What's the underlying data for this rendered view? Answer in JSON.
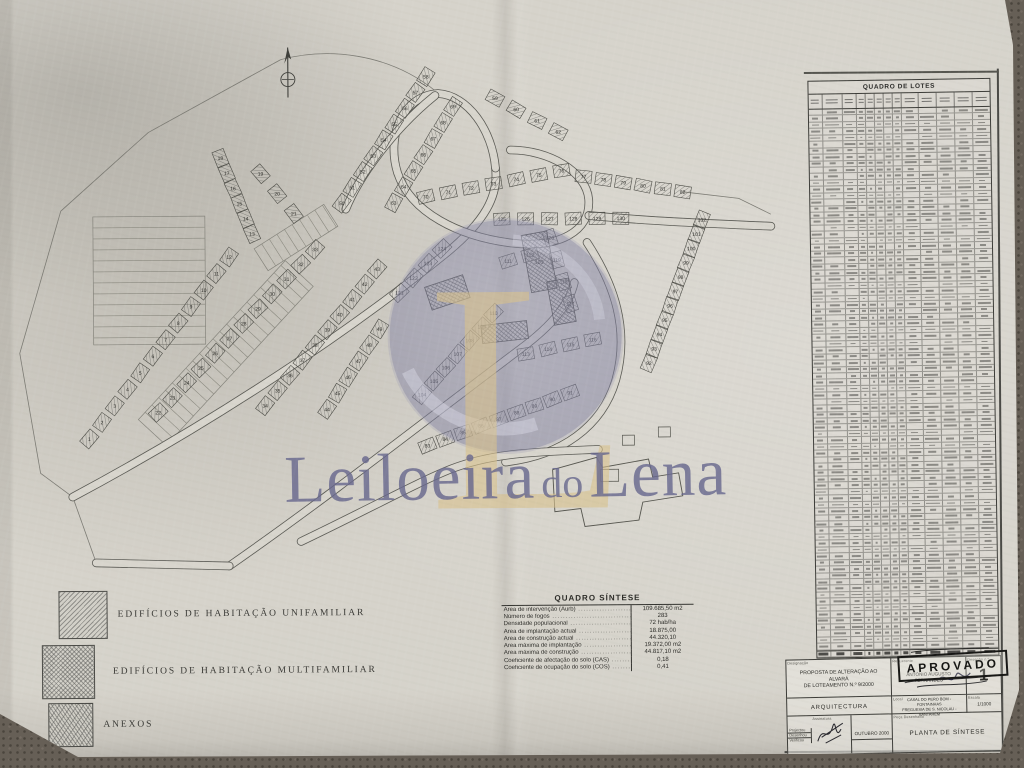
{
  "watermark": {
    "brand_left": "Leiloeira",
    "brand_mid": "do",
    "brand_right": "Lena",
    "monogram": "L"
  },
  "north_arrow": "north-arrow",
  "legend": {
    "items": [
      {
        "label": "EDIFÍCIOS  DE  HABITAÇÃO  UNIFAMILIAR",
        "pattern": "diagonal-hatch"
      },
      {
        "label": "EDIFÍCIOS  DE  HABITAÇÃO  MULTIFAMILIAR",
        "pattern": "cross-hatch"
      },
      {
        "label": "ANEXOS",
        "pattern": "zigzag-hatch"
      }
    ]
  },
  "quadro_sintese": {
    "title": "QUADRO SÍNTESE",
    "rows": [
      [
        "Área de intervenção (Aurb)",
        "109.685,50  m2"
      ],
      [
        "Número de fogos",
        "283"
      ],
      [
        "Densidade populacional",
        "72  hab/ha"
      ],
      [
        "Área de implantação actual",
        "18.875,00"
      ],
      [
        "Área de construção actual",
        "44.320,10"
      ],
      [
        "Área máxima de implantação",
        "19.372,00  m2"
      ],
      [
        "Área máxima de construção",
        "44.817,10  m2"
      ],
      [
        "Coeficiente de afectação do solo (CAS)",
        "0,18"
      ],
      [
        "Coeficiente de ocupação do solo (COS)",
        "0,41"
      ]
    ]
  },
  "quadro_lotes": {
    "title": "QUADRO DE LOTES",
    "row_count": 84,
    "column_count": 13
  },
  "title_block": {
    "designacao_label": "Designação",
    "designacao_line1": "PROPOSTA DE ALTERAÇÃO AO ALVARÁ",
    "designacao_line2": "DE LOTEAMENTO N.º 9/2000",
    "requerente_label": "Requerente",
    "requerente": "ANTÓNIO AUGUSTO FERNANDES",
    "desenho_label": "Desenho n.º",
    "desenho_num": "1",
    "especialidade": "ARQUITECTURA",
    "local_label": "Local",
    "local_line1": "CASAL DO PERO BOM - FONTAINHAS",
    "local_line2": "FREGUESIA DE S. NICOLAU - SANTARÉM",
    "escala_label": "Escala",
    "escala": "1/1000",
    "sig_rows": [
      "Projectou",
      "Desenhou",
      "Verificou"
    ],
    "assinatura_label": "Assinatura",
    "data_label": "Data",
    "data_value": "OUTUBRO 2000",
    "peca_label": "Peça Desenhada",
    "peca": "PLANTA DE SÍNTESE"
  },
  "stamp": {
    "label": "APROVADO"
  },
  "plan": {
    "lot_clusters": [
      {
        "from": 1,
        "to": 12,
        "x1": 89,
        "y1": 436,
        "x2": 230,
        "y2": 255
      },
      {
        "from": 13,
        "to": 18,
        "x1": 253,
        "y1": 232,
        "x2": 222,
        "y2": 156
      },
      {
        "from": 19,
        "to": 21,
        "x1": 262,
        "y1": 172,
        "x2": 295,
        "y2": 212
      },
      {
        "from": 22,
        "to": 33,
        "x1": 158,
        "y1": 410,
        "x2": 316,
        "y2": 248
      },
      {
        "from": 34,
        "to": 43,
        "x1": 265,
        "y1": 404,
        "x2": 378,
        "y2": 268
      },
      {
        "from": 44,
        "to": 49,
        "x1": 327,
        "y1": 408,
        "x2": 380,
        "y2": 328
      },
      {
        "from": 50,
        "to": 58,
        "x1": 343,
        "y1": 202,
        "x2": 428,
        "y2": 76
      },
      {
        "from": 59,
        "to": 62,
        "x1": 497,
        "y1": 98,
        "x2": 560,
        "y2": 132
      },
      {
        "from": 63,
        "to": 69,
        "x1": 395,
        "y1": 202,
        "x2": 455,
        "y2": 106
      },
      {
        "from": 70,
        "to": 76,
        "x1": 427,
        "y1": 196,
        "x2": 563,
        "y2": 171
      },
      {
        "from": 77,
        "to": 82,
        "x1": 585,
        "y1": 177,
        "x2": 684,
        "y2": 193
      },
      {
        "from": 83,
        "to": 91,
        "x1": 427,
        "y1": 445,
        "x2": 570,
        "y2": 393
      },
      {
        "from": 92,
        "to": 102,
        "x1": 649,
        "y1": 364,
        "x2": 703,
        "y2": 221
      },
      {
        "from": 104,
        "to": 110,
        "x1": 422,
        "y1": 394,
        "x2": 494,
        "y2": 313
      },
      {
        "from": 111,
        "to": 112,
        "x1": 509,
        "y1": 261,
        "x2": 531,
        "y2": 255
      },
      {
        "from": 113,
        "to": 116,
        "x1": 526,
        "y1": 354,
        "x2": 593,
        "y2": 340
      },
      {
        "from": 117,
        "to": 120,
        "x1": 571,
        "y1": 304,
        "x2": 551,
        "y2": 238
      },
      {
        "from": 121,
        "to": 124,
        "x1": 400,
        "y1": 292,
        "x2": 443,
        "y2": 248
      },
      {
        "from": 125,
        "to": 130,
        "x1": 503,
        "y1": 219,
        "x2": 622,
        "y2": 219
      }
    ],
    "multi_blocks": [
      {
        "n": "103",
        "x": 540,
        "y": 262,
        "w": 26,
        "h": 58,
        "r": -10
      },
      {
        "n": "",
        "x": 562,
        "y": 302,
        "w": 22,
        "h": 44,
        "r": -10
      },
      {
        "n": "",
        "x": 448,
        "y": 292,
        "w": 40,
        "h": 24,
        "r": -18
      },
      {
        "n": "",
        "x": 505,
        "y": 332,
        "w": 46,
        "h": 18,
        "r": -6
      }
    ],
    "roads": [
      "M 72,494 C 190,432 330,346 448,252 C 486,221 500,196 497,168",
      "M 228,564 C 330,494 425,420 522,348 C 552,326 570,305 575,283",
      "M 497,168 C 494,130 470,95 440,93 C 404,95 388,136 399,172 C 412,212 460,236 512,243 C 560,249 592,232 590,200 C 588,172 550,150 512,150",
      "M 590,216 C 650,222 710,225 772,228",
      "M 588,243 C 615,285 630,330 616,380 C 602,428 560,456 505,462",
      "M 300,540 C 360,512 420,480 452,468 C 495,452 540,452 598,450",
      "M 347,208 C 362,172 398,126 437,95",
      "M 95,560 L 228,564"
    ],
    "boundary": [
      "M 283,58 L 150,130 L 62,208 L 20,350 L 40,470 L 72,494",
      "M 283,58 C 330,46 390,52 437,90",
      "M 72,494 L 95,560 L 228,564",
      "M 684,193 L 740,200 L 772,216"
    ],
    "strips": [
      {
        "x1": 152,
        "y1": 430,
        "x2": 300,
        "y2": 272,
        "w": 38,
        "step": 10
      },
      {
        "x1": 150,
        "y1": 214,
        "x2": 150,
        "y2": 342,
        "w": 112,
        "step": 11
      },
      {
        "x1": 262,
        "y1": 258,
        "x2": 332,
        "y2": 214,
        "w": 26,
        "step": 9
      }
    ],
    "school_outline": "M 552,470 L 596,458 L 602,468 L 648,460 L 652,478 L 678,474 L 682,497 L 642,503 L 638,521 L 584,527 L 580,509 L 554,512 Z",
    "school_small": [
      {
        "x": 600,
        "y": 470,
        "w": 18,
        "h": 12
      },
      {
        "x": 622,
        "y": 436,
        "w": 12,
        "h": 10
      },
      {
        "x": 658,
        "y": 428,
        "w": 12,
        "h": 10
      }
    ]
  }
}
